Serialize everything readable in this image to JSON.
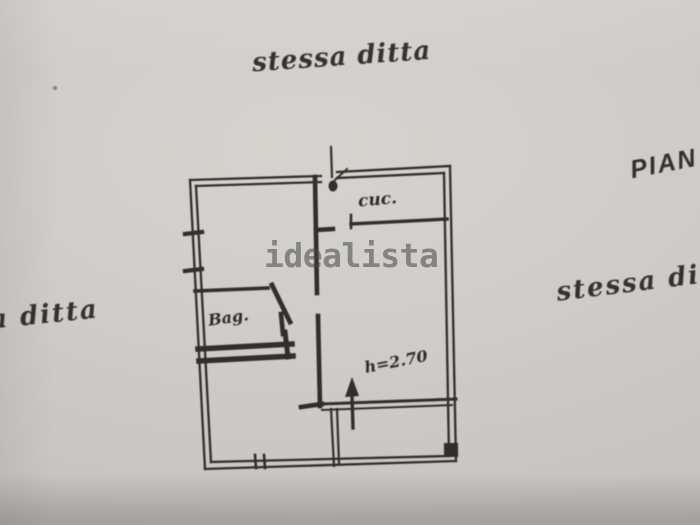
{
  "annotations": {
    "top_note": "stessa ditta",
    "plan_title_fragment": "PIAN",
    "right_note_fragment": "stessa dit",
    "left_note_fragment": "a ditta"
  },
  "plan_labels": {
    "kitchen": "cuc.",
    "bathroom": "Bag.",
    "ceiling_height": "h=2.70"
  },
  "watermark": {
    "text": "idealista",
    "color": "#8d8d8d"
  },
  "colors": {
    "paper": "#cdcbc7",
    "ink": "#25221e"
  }
}
